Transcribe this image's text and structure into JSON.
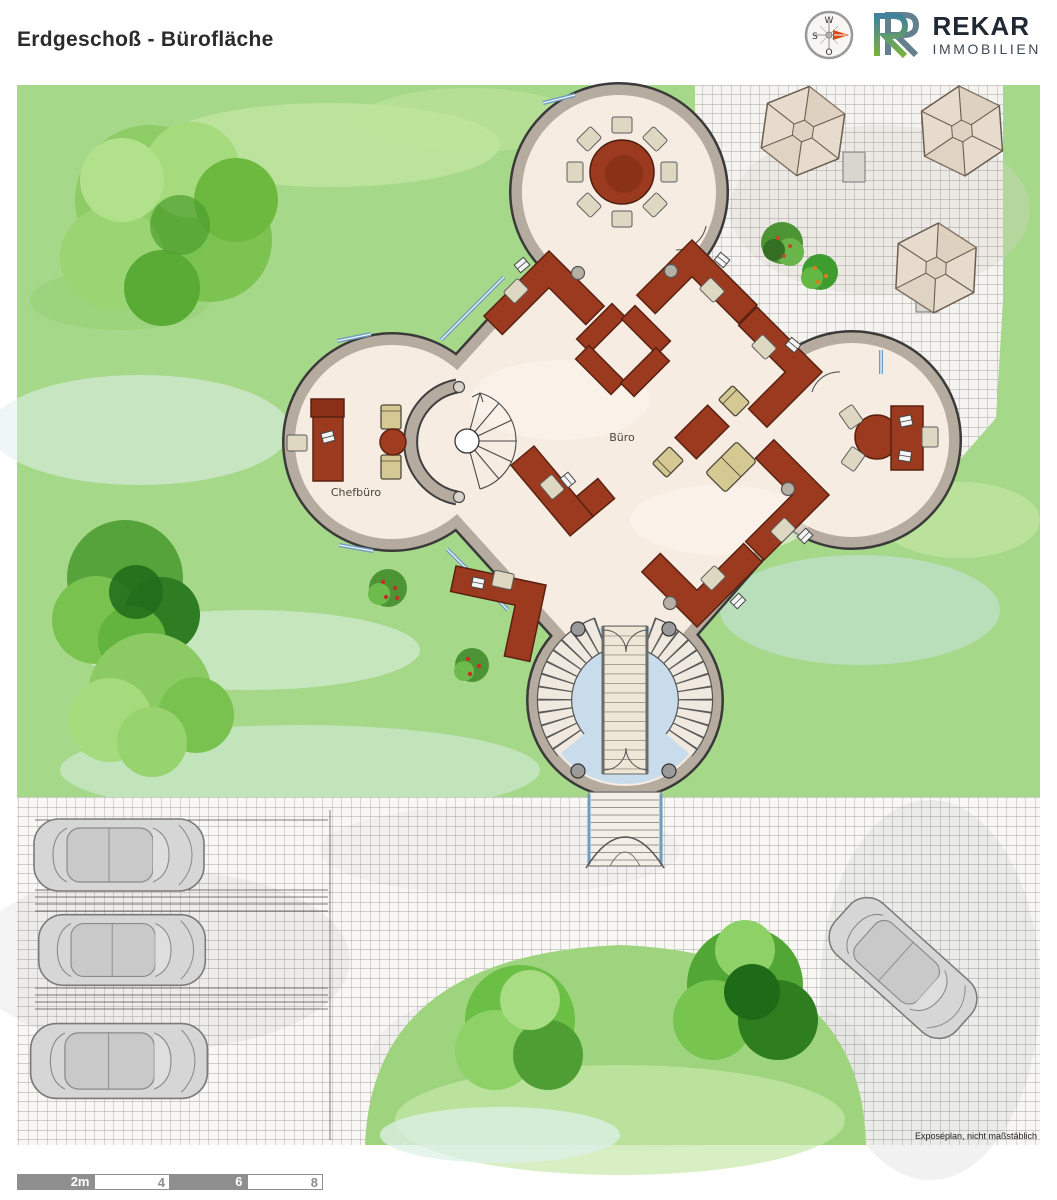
{
  "header": {
    "title": "Erdgeschoß - Bürofläche",
    "brand": {
      "name": "REKAR",
      "subtitle": "IMMOBILIEN"
    },
    "compass": {
      "top": "W",
      "left": "S",
      "bottom": "O"
    }
  },
  "plan": {
    "rooms": {
      "chefbuero": "Chefbüro",
      "buero": "Büro"
    },
    "footnote": "Exposéplan, nicht maßstäblich"
  },
  "scalebar": {
    "segments": [
      {
        "label": "2m"
      },
      {
        "label": "4"
      },
      {
        "label": "6"
      },
      {
        "label": "8"
      }
    ]
  },
  "colors": {
    "lawn": "#a6d88a",
    "floor": "#f6ece2",
    "wall": "#b5ab9e",
    "wall_outline": "#3a3a3a",
    "desk": "#9c3a20",
    "chair_beige": "#ded8c2",
    "chair_khaki": "#d6c893",
    "entrance_floor": "#c9dcec",
    "window_blue": "#6f9cbf",
    "scalebar_gray": "#8f8f8f",
    "compass_arrow": "#d84a1b",
    "logo_blue": "#40829e",
    "logo_green": "#79b23f",
    "car_gray": "#d6d6d6"
  }
}
